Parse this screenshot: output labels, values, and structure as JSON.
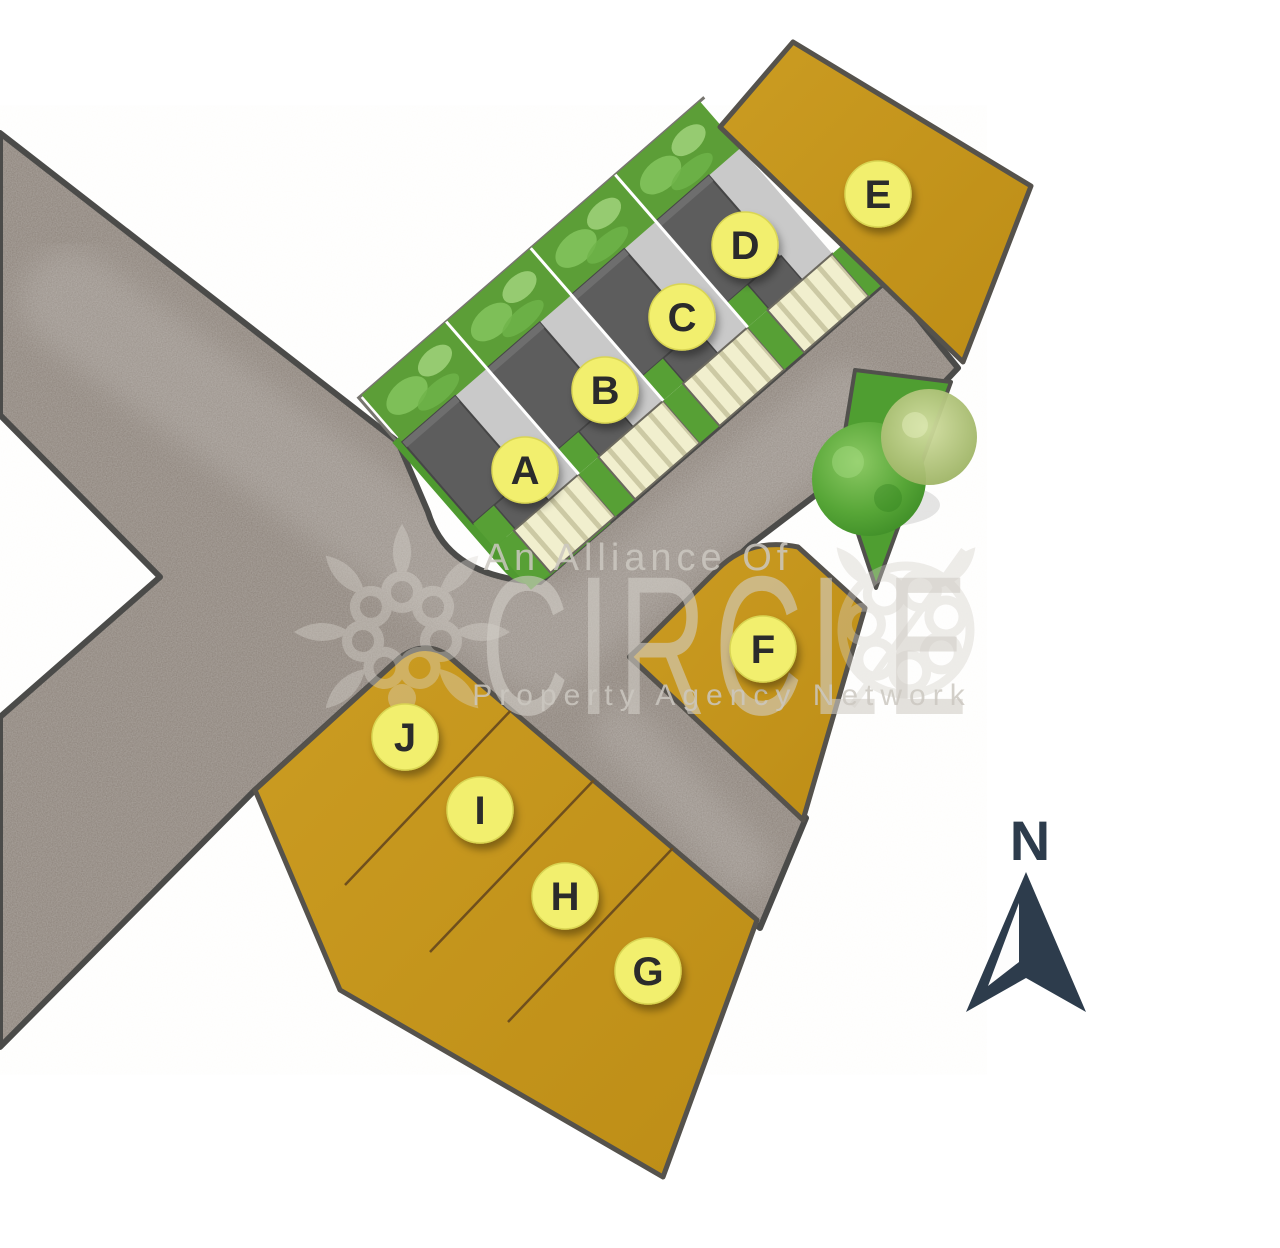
{
  "title": "Residential land plot site plan",
  "plots": [
    {
      "label": "A",
      "x": 525,
      "y": 470,
      "type": "house"
    },
    {
      "label": "B",
      "x": 605,
      "y": 390,
      "type": "house"
    },
    {
      "label": "C",
      "x": 682,
      "y": 317,
      "type": "house"
    },
    {
      "label": "D",
      "x": 745,
      "y": 245,
      "type": "house"
    },
    {
      "label": "E",
      "x": 878,
      "y": 194,
      "type": "land"
    },
    {
      "label": "F",
      "x": 763,
      "y": 649,
      "type": "land"
    },
    {
      "label": "G",
      "x": 648,
      "y": 971,
      "type": "land"
    },
    {
      "label": "H",
      "x": 565,
      "y": 896,
      "type": "land"
    },
    {
      "label": "I",
      "x": 480,
      "y": 810,
      "type": "land"
    },
    {
      "label": "J",
      "x": 405,
      "y": 737,
      "type": "land"
    }
  ],
  "watermark": {
    "line1": "An Alliance Of",
    "brand": "CIRCLE",
    "line2": "Property Agency Network"
  },
  "compass": {
    "north_label": "N"
  },
  "colors": {
    "parcel_gold": "#c6981f",
    "road_gray": "#8b8179",
    "road_border": "#4b4b49",
    "grass_green": "#57a035",
    "roof_gray": "#5d5d5d",
    "driveway_gray": "#c9c9c9",
    "parking_cream": "#f1efce",
    "marker_yellow": "#f2ef6e",
    "compass_navy": "#2d3c4c",
    "watermark_gray": "#d6d2cb"
  }
}
